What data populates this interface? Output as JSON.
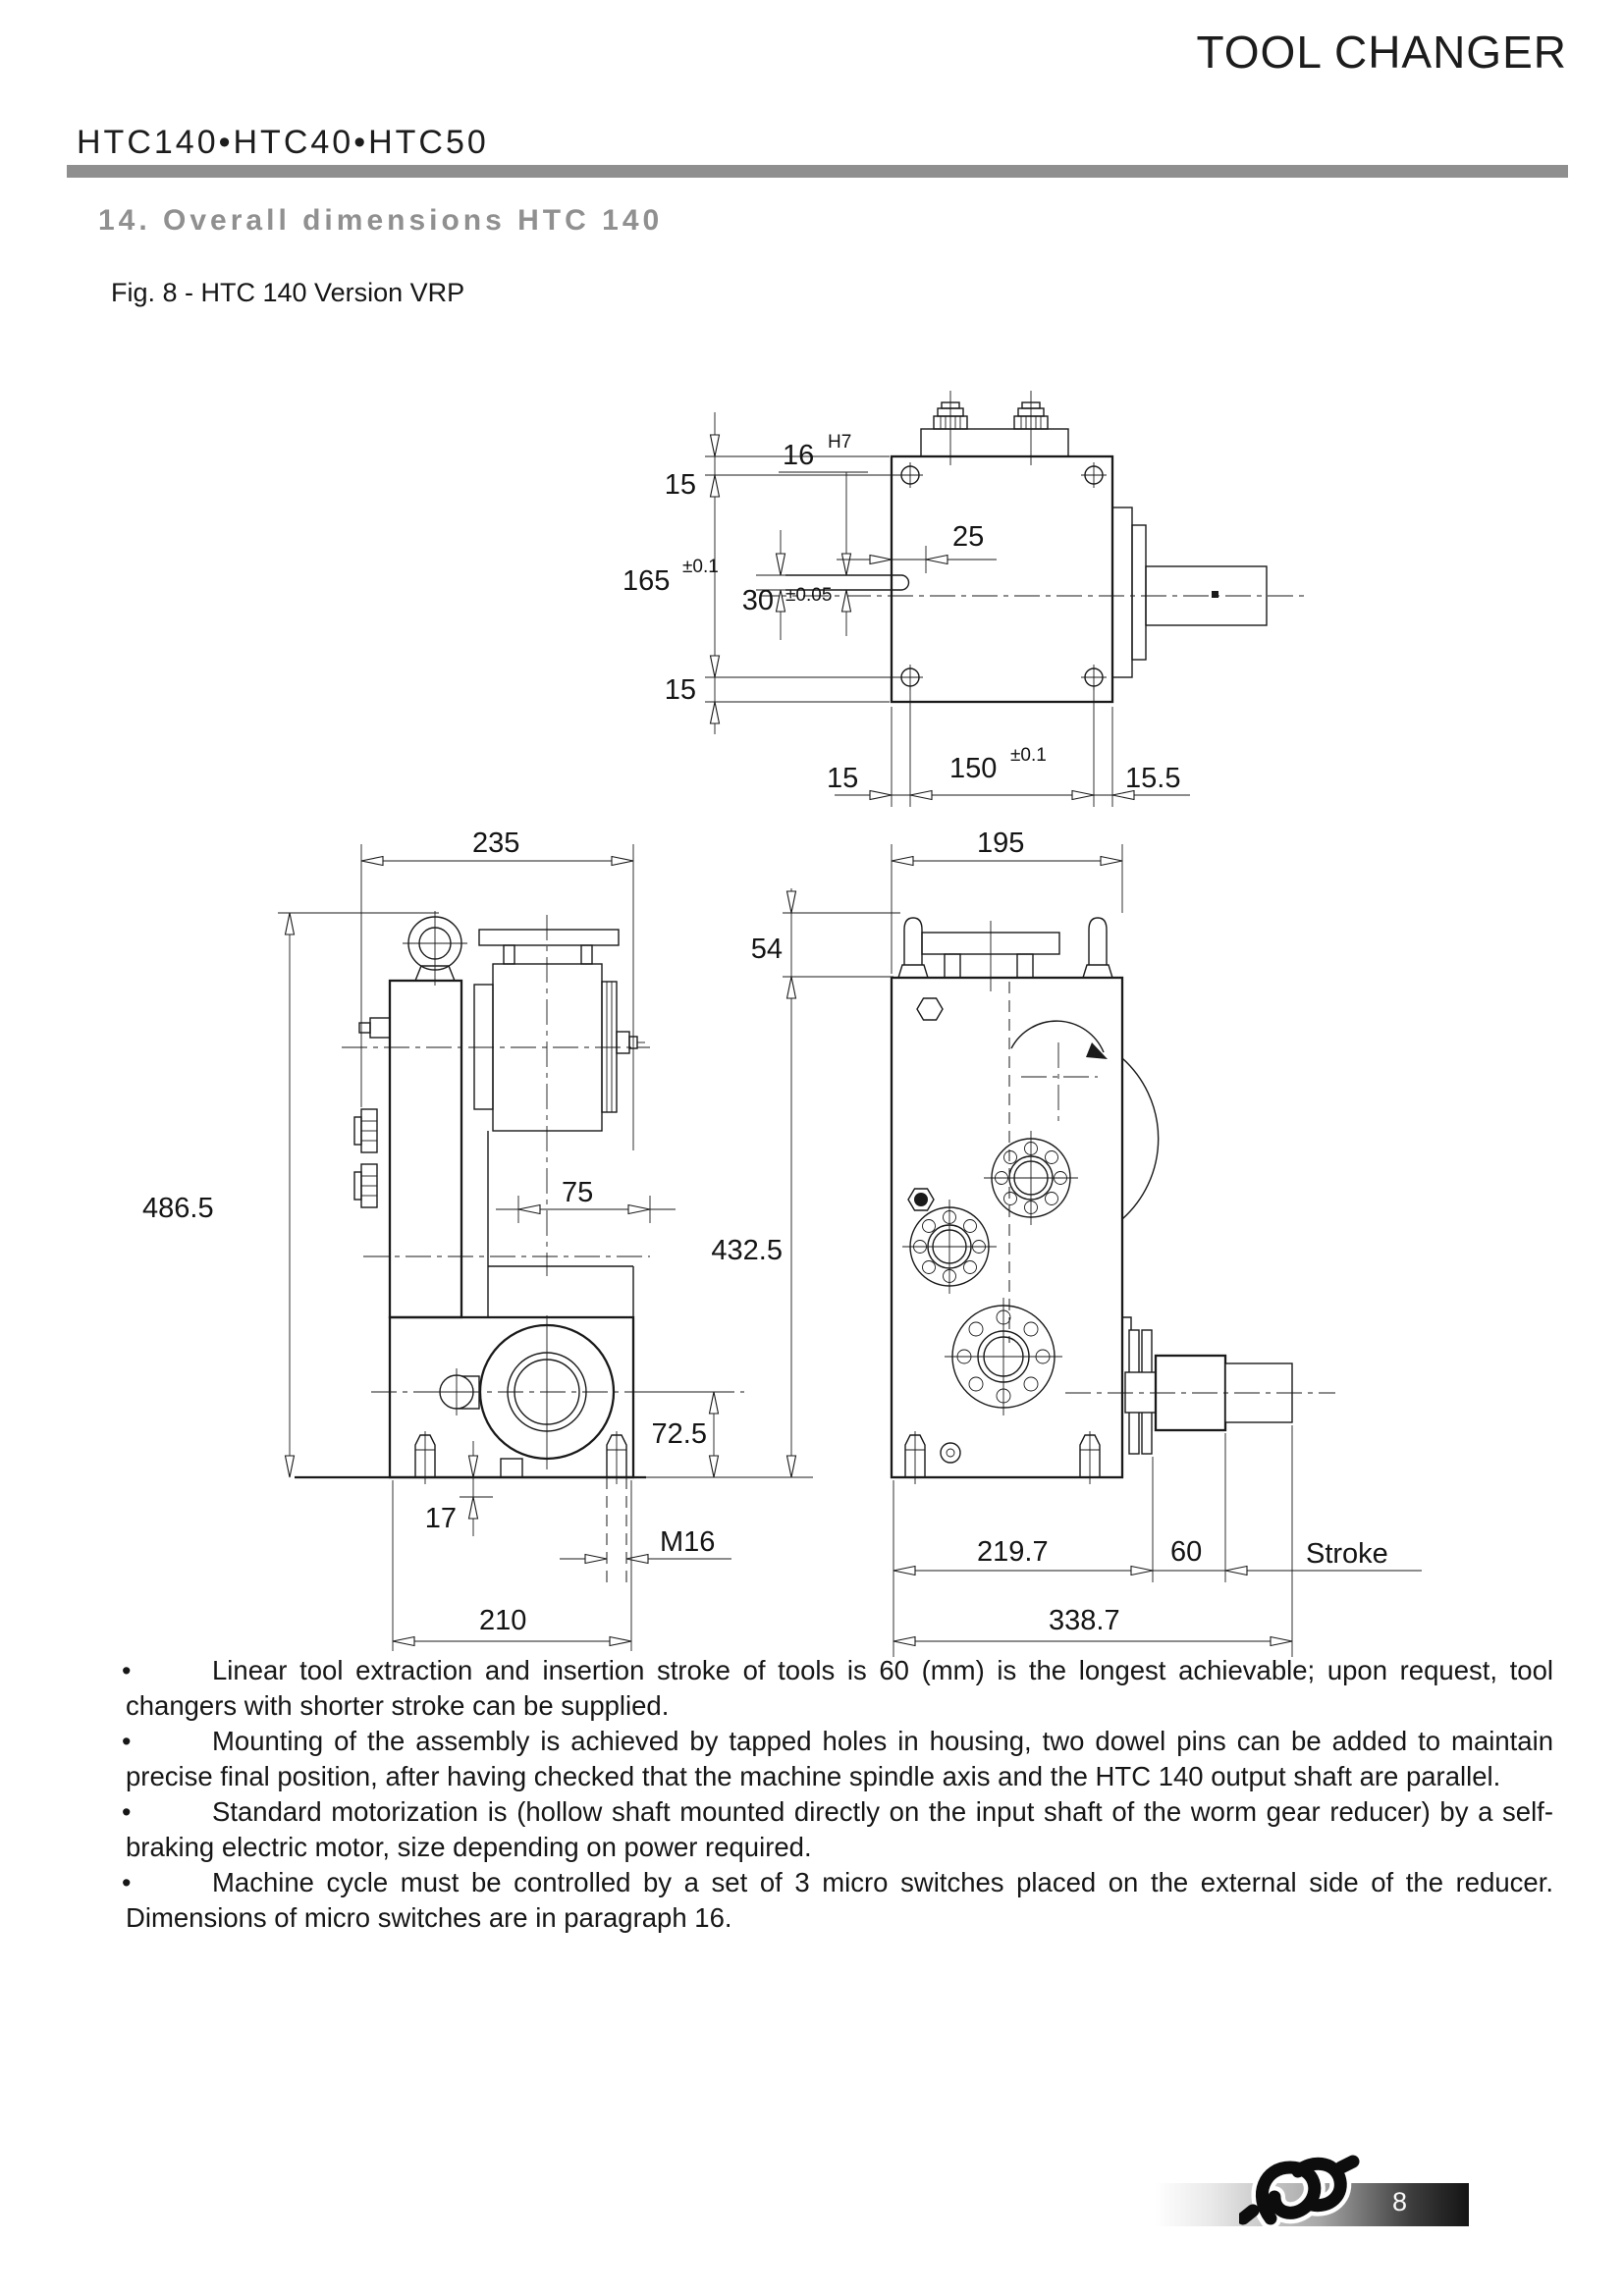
{
  "header": {
    "doc_title": "TOOL CHANGER",
    "models": "HTC140•HTC40•HTC50"
  },
  "section": {
    "title": "14. Overall dimensions HTC 140",
    "figure_caption": "Fig. 8 - HTC 140 Version VRP"
  },
  "drawing": {
    "top_view": {
      "v15_top": "15",
      "v165": "165",
      "v165_tol": "±0.1",
      "v15_bottom": "15",
      "d16": "16",
      "d16_fit": "H7",
      "d25": "25",
      "d30": "30",
      "d30_tol": "±0.05",
      "h15": "15",
      "h150": "150",
      "h150_tol": "±0.1",
      "h15_5": "15.5"
    },
    "side_view": {
      "d235": "235",
      "d486_5": "486.5",
      "d75": "75",
      "d72_5": "72.5",
      "d17": "17",
      "m16": "M16",
      "d210": "210"
    },
    "front_view": {
      "d195": "195",
      "d54": "54",
      "d432_5": "432.5",
      "d219_7": "219.7",
      "d60": "60",
      "stroke_label": "Stroke",
      "d338_7": "338.7"
    }
  },
  "notes_bullet": "•",
  "notes": [
    "Linear tool extraction and insertion stroke of tools is 60 (mm) is the longest achievable; upon request, tool changers with shorter stroke can be supplied.",
    "Mounting of the assembly is achieved by tapped holes in housing, two dowel pins can be added to maintain precise final position, after having checked that the machine spindle axis and the HTC 140 output shaft are parallel.",
    "Standard motorization is (hollow shaft mounted directly on the input shaft of the worm gear reducer) by a self-braking electric motor, size depending on power required.",
    "Machine cycle must be controlled by a set of 3 micro switches placed on the external side of the reducer. Dimensions of micro switches are in paragraph 16."
  ],
  "footer": {
    "page_number": "8"
  }
}
